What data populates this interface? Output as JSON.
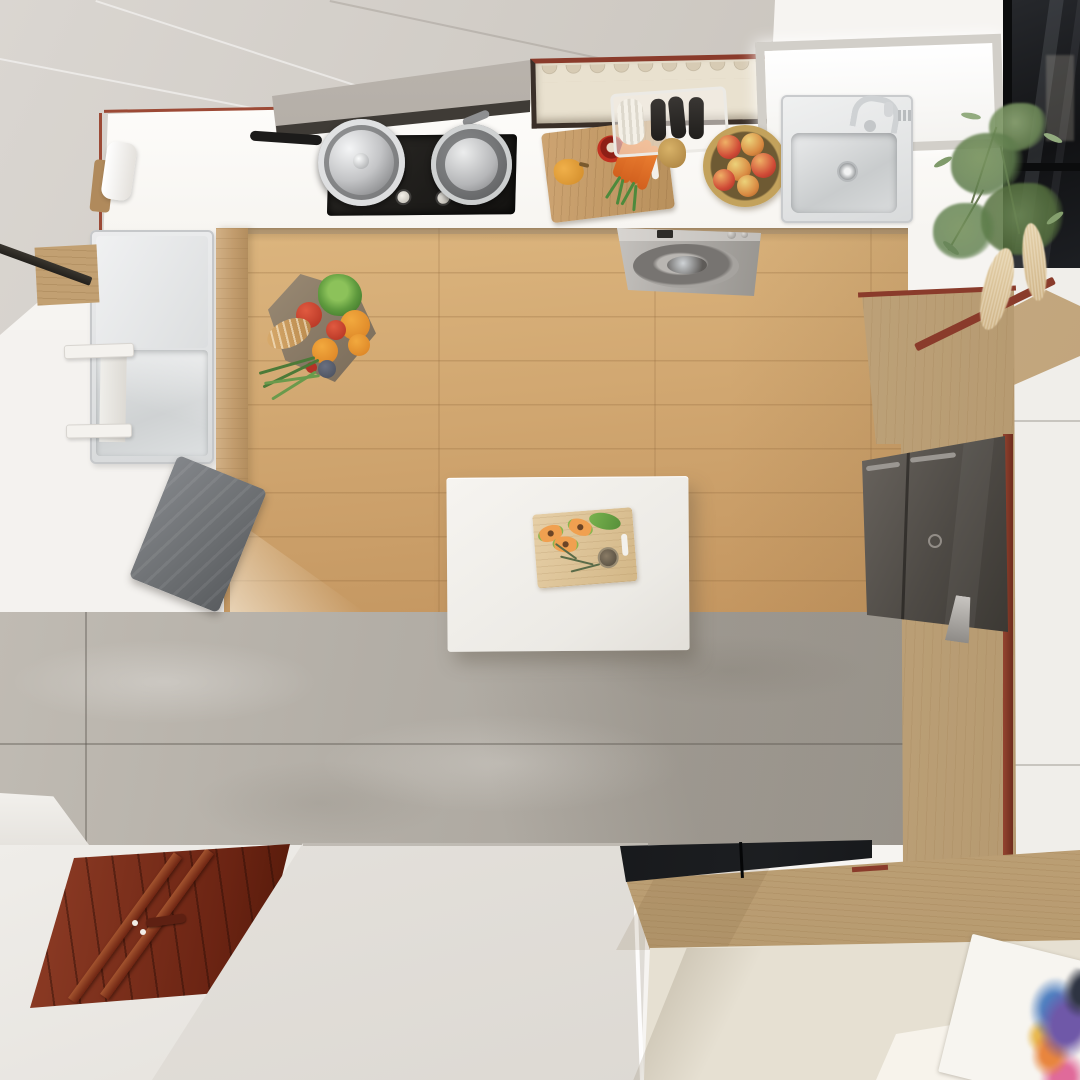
{
  "scene": {
    "description": "Top-down 3D render of a small modern kitchen with oak floor, white island, gray marble tile and a mahogany entry door",
    "view": "overhead"
  },
  "objects": {
    "upper_cabinets": {
      "label": "Glossy greige upper cabinets"
    },
    "plate_cabinet": {
      "label": "Glass-front plate rack cabinet"
    },
    "skylight": {
      "label": "Ceiling skylight"
    },
    "glass_cabinet": {
      "label": "Black-framed smoked glass cabinet"
    },
    "range_hood": {
      "label": "Stainless range hood"
    },
    "cooktop": {
      "label": "Black gas cooktop with two burners"
    },
    "pot_left": {
      "label": "Lidded steel pot on burner"
    },
    "pot_right": {
      "label": "Steel saucepan on burner"
    },
    "prep_board": {
      "label": "Cutting board with peppers and carrots"
    },
    "dish_rack": {
      "label": "Dish rack with dark bottles and towel roll"
    },
    "onion": {
      "label": "Onion on counter"
    },
    "fruit_bowl": {
      "label": "Brass bowl filled with apples"
    },
    "kitchen_sink": {
      "label": "Stainless kitchen sink with faucet"
    },
    "washer": {
      "label": "Under-counter washing machine"
    },
    "wood_floor": {
      "label": "Oak plank kitchen floor"
    },
    "grocery_basket": {
      "label": "Cloth basket of fresh produce on the floor"
    },
    "utility_sink": {
      "label": "Long utility sink with drainboard"
    },
    "kettle": {
      "label": "White kettle on counter"
    },
    "towel": {
      "label": "Gray towel on the floor"
    },
    "island": {
      "label": "White kitchen island"
    },
    "island_board": {
      "label": "Cutting board with papaya slices and herbs"
    },
    "refrigerator": {
      "label": "Dark gray two-door refrigerator"
    },
    "wood_panel": {
      "label": "Oak wall paneling with red trim"
    },
    "tile_floor": {
      "label": "Gray marble tile floor band"
    },
    "entry_door": {
      "label": "Mahogany double entry door seen from above"
    },
    "white_slab": {
      "label": "White partition wall top"
    },
    "partition_glass": {
      "label": "Smoked glass partition strip"
    },
    "half_wall": {
      "label": "Oak half wall"
    },
    "hallway_floor": {
      "label": "Beige hallway floor"
    },
    "rug": {
      "label": "White rug with abstract paint print"
    },
    "houseplant": {
      "label": "Potted plant with pampas grass"
    },
    "step": {
      "label": "White step ledge"
    }
  },
  "palette": {
    "bg": "#f6f4f1",
    "cabinet": "#cbc6bf",
    "cabinet-light": "#dad6d1",
    "counter": "#f7f5f1",
    "hood": "#948e87",
    "cooktop": "#141311",
    "board": "#b8905c",
    "carrot": "#d2601e",
    "pepper-red": "#c23222",
    "pepper-yellow": "#d08a28",
    "bowl-gold": "#c3a25c",
    "apple": "#cf4a36",
    "washer": "#a7a4a0",
    "wood-floor": "#cda26c",
    "island": "#eceae5",
    "towel": "#6b6e71",
    "tile": "#b3aea6",
    "fridge": "#4e4a45",
    "wood-panel": "#c3a87f",
    "trim-red": "#8a3b2b",
    "door": "#6b2413",
    "slab": "#e7e4df",
    "glass-dark": "#111214",
    "half-wall": "#c4a87e",
    "beige-floor": "#e6e0d2",
    "pampas": "#cdb183",
    "rug": "#f7f5f0",
    "skylight-frame": "#d2cfc9"
  }
}
